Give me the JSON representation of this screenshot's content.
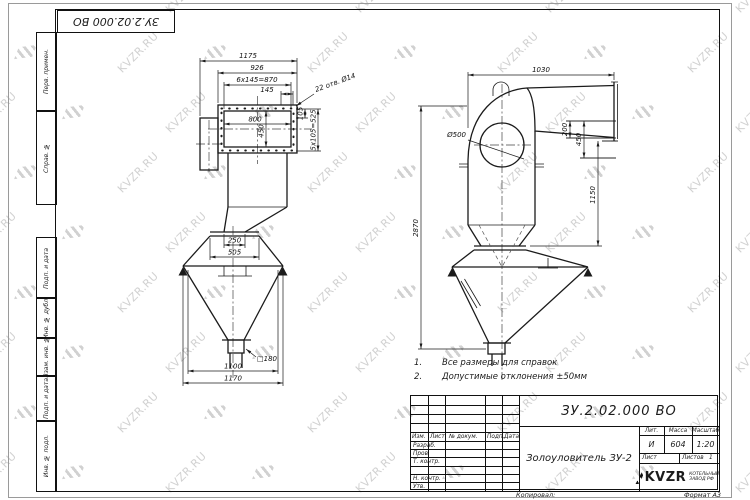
{
  "watermark": {
    "text": "KVZR.RU",
    "color": "#c9c9c9"
  },
  "stamp_top": {
    "doc_number": "ЗУ.2.02.000 ВО"
  },
  "margin_labels": {
    "perv": "Перв. примен.",
    "sprav": "Справ. №",
    "podp1": "Подп. и дата",
    "inv_dubl": "Инв. № дубл.",
    "vzam": "Взам. инв. №",
    "podp2": "Подп. и дата",
    "inv_podl": "Инв. № подл."
  },
  "notes": {
    "n1_num": "1.",
    "n1_text": "Все размеры для справок",
    "n2_num": "2.",
    "n2_text": "Допустимые отклонения ±50мм"
  },
  "title_block": {
    "doc_number": "ЗУ.2.02.000 ВО",
    "product_name": "Золоуловитель ЗУ-2",
    "col_izm": "Изм.",
    "col_list": "Лист",
    "col_doc": "№ докум.",
    "col_podp": "Подп.",
    "col_data": "Дата",
    "row_razrab": "Разраб.",
    "row_prov": "Пров.",
    "row_tkontr": "Т. контр.",
    "row_nkontr": "Н. контр.",
    "row_utv": "Утв.",
    "lit_label": "Лит.",
    "mass_label": "Масса",
    "scale_label": "Масштаб",
    "lit_value": "И",
    "mass_value": "604",
    "scale_value": "1:20",
    "sheet_label": "Лист",
    "sheets_label": "Листов",
    "sheets_value": "1",
    "logo_text": "KVZR",
    "logo_sub1": "КОТЕЛЬНЫЙ",
    "logo_sub2": "ЗАВОД РФ",
    "copied_label": "Копировал:",
    "format_label": "Формат А3"
  },
  "views": {
    "front": {
      "dims": {
        "w1175": "1175",
        "w926": "926",
        "w870": "6x145=870",
        "w145": "145",
        "holes": "22 отв. Ø14",
        "w800": "800",
        "h450": "450",
        "h105": "105",
        "h525": "5x105=525",
        "w250": "250",
        "w505": "505",
        "sq180": "□180",
        "w1100": "1100",
        "w1170": "1170"
      }
    },
    "side": {
      "dims": {
        "w1030": "1030",
        "dia500": "Ø500",
        "h200": "200",
        "h450": "450",
        "h1150": "1150",
        "h2870": "2870"
      }
    }
  }
}
